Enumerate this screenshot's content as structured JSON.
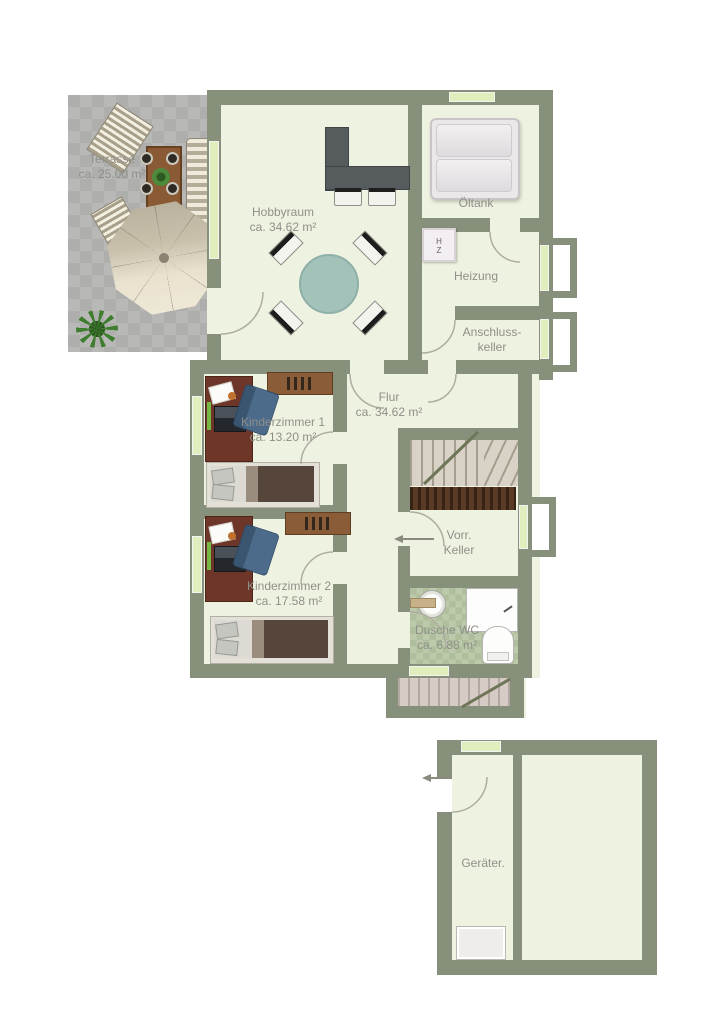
{
  "palette": {
    "wall": "#87907b",
    "floor": "#eef3e1",
    "window": "#dfeebc",
    "terraceGray": "#b4b4b2",
    "label": "#8f8f88",
    "wood": "#8a5c38",
    "desk": "#6e3628",
    "counter": "#565c5e",
    "tableTeal": "#a3c2ba",
    "stair": "#d9d3c7",
    "understair": "#5b3a23",
    "extstair": "#d6ccc5",
    "tank": "#ece8ea",
    "tile": "#bcc9aa"
  },
  "rooms": {
    "terrasse": {
      "name": "Terrasse",
      "area": "ca. 25.00 m²"
    },
    "hobbyraum": {
      "name": "Hobbyraum",
      "area": "ca. 34.62 m²"
    },
    "oeltank": {
      "name": "Öltank"
    },
    "heizung": {
      "name": "Heizung"
    },
    "anschlusskeller": {
      "name_line1": "Anschluss-",
      "name_line2": "keller"
    },
    "kinderzimmer1": {
      "name": "Kinderzimmer 1",
      "area": "ca. 13.20 m²"
    },
    "flur": {
      "name": "Flur",
      "area": "ca. 34.62 m²"
    },
    "kinderzimmer2": {
      "name": "Kinderzimmer 2",
      "area": "ca. 17.58 m²"
    },
    "vorrkeller": {
      "name_line1": "Vorr.",
      "name_line2": "Keller"
    },
    "duschewc": {
      "name": "Dusche WC",
      "area": "ca. 6.88 m²"
    },
    "geraeteraum": {
      "name": "Geräter."
    }
  },
  "heater_unit": {
    "line1": "H",
    "line2": "Z"
  }
}
